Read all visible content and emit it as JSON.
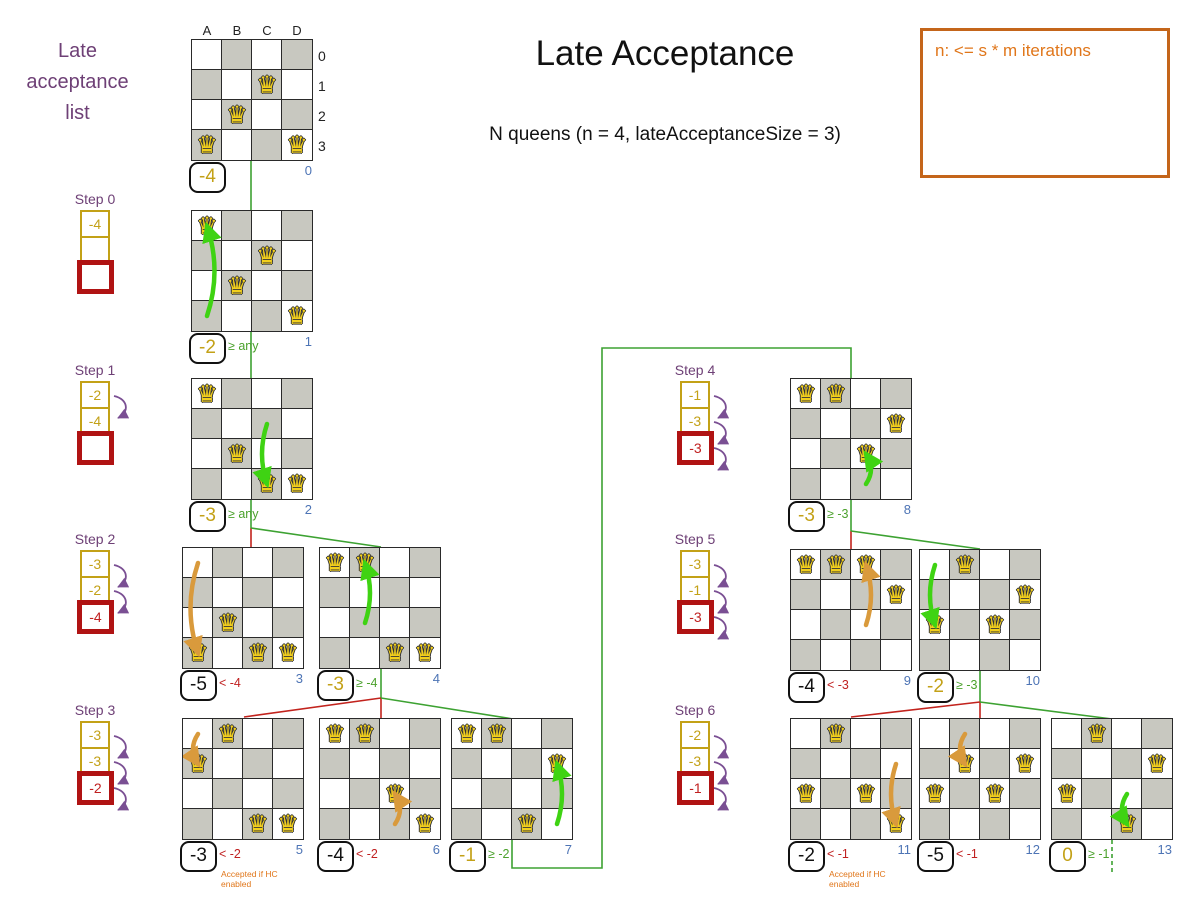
{
  "title": "Late Acceptance",
  "subtitle": "N queens (n = 4, lateAcceptanceSize = 3)",
  "info_box": {
    "text": "n: <= s * m iterations"
  },
  "left_label": {
    "text": "Late\nacceptance\nlist"
  },
  "icons": {
    "queen": "♛",
    "shift_arrow": "curved-purple-arrow"
  },
  "colors": {
    "gold": "#c3a117",
    "score_black": "#111111",
    "red_text": "#c02020",
    "red_line": "#c2231d",
    "red_cell_border": "#b01313",
    "green_text": "#4ba12c",
    "green_line": "#3da232",
    "green_arrow": "#3fd313",
    "orange_arrow": "#d99a3c",
    "orange_text": "#e0761a",
    "purple": "#6e4076",
    "purple_arrow": "#7a4f93",
    "blue_index": "#4d74b5",
    "cell_gray": "#c8c8c0",
    "cell_white": "#ffffff"
  },
  "board_labels": {
    "cols": [
      "A",
      "B",
      "C",
      "D"
    ],
    "rows": [
      "0",
      "1",
      "2",
      "3"
    ]
  },
  "steps": [
    {
      "label": "Step 0",
      "x": 80,
      "y": 191,
      "cells": [
        "-4",
        "",
        ""
      ],
      "arrows": 0
    },
    {
      "label": "Step 1",
      "x": 80,
      "y": 362,
      "cells": [
        "-2",
        "-4",
        ""
      ],
      "arrows": 1
    },
    {
      "label": "Step 2",
      "x": 80,
      "y": 531,
      "cells": [
        "-3",
        "-2",
        "-4"
      ],
      "arrows": 2
    },
    {
      "label": "Step 3",
      "x": 80,
      "y": 702,
      "cells": [
        "-3",
        "-3",
        "-2"
      ],
      "arrows": 3
    },
    {
      "label": "Step 4",
      "x": 680,
      "y": 362,
      "cells": [
        "-1",
        "-3",
        "-3"
      ],
      "arrows": 3
    },
    {
      "label": "Step 5",
      "x": 680,
      "y": 531,
      "cells": [
        "-3",
        "-1",
        "-3"
      ],
      "arrows": 3
    },
    {
      "label": "Step 6",
      "x": 680,
      "y": 702,
      "cells": [
        "-2",
        "-3",
        "-1"
      ],
      "arrows": 3
    }
  ],
  "boards": [
    {
      "id": 0,
      "x": 191,
      "y": 39,
      "queens": [
        "C1",
        "B2",
        "A3",
        "D3"
      ],
      "score": "-4",
      "score_color": "gold",
      "cond": "",
      "cond_color": "",
      "index": "0",
      "labels": true
    },
    {
      "id": 1,
      "x": 191,
      "y": 210,
      "queens": [
        "A0",
        "C1",
        "B2",
        "D3"
      ],
      "move": {
        "from": "A3",
        "to": "A0",
        "color": "green"
      },
      "score": "-2",
      "score_color": "gold",
      "cond": "≥ any",
      "cond_color": "green",
      "index": "1"
    },
    {
      "id": 2,
      "x": 191,
      "y": 378,
      "queens": [
        "A0",
        "B2",
        "C3",
        "D3"
      ],
      "move": {
        "from": "C1",
        "to": "C3",
        "color": "green"
      },
      "score": "-3",
      "score_color": "gold",
      "cond": "≥ any",
      "cond_color": "green",
      "index": "2"
    },
    {
      "id": 3,
      "x": 182,
      "y": 547,
      "queens": [
        "B2",
        "A3",
        "C3",
        "D3"
      ],
      "move": {
        "from": "A0",
        "to": "A3",
        "color": "orange"
      },
      "score": "-5",
      "score_color": "black",
      "cond": "< -4",
      "cond_color": "red",
      "index": "3"
    },
    {
      "id": 4,
      "x": 319,
      "y": 547,
      "queens": [
        "A0",
        "B0",
        "C3",
        "D3"
      ],
      "move": {
        "from": "B2",
        "to": "B0",
        "color": "green"
      },
      "score": "-3",
      "score_color": "gold",
      "cond": "≥ -4",
      "cond_color": "green",
      "index": "4"
    },
    {
      "id": 5,
      "x": 182,
      "y": 718,
      "queens": [
        "B0",
        "A1",
        "C3",
        "D3"
      ],
      "move": {
        "from": "A0",
        "to": "A1",
        "color": "orange"
      },
      "score": "-3",
      "score_color": "black",
      "cond": "< -2",
      "cond_color": "red",
      "index": "5",
      "note": "Accepted if HC enabled"
    },
    {
      "id": 6,
      "x": 319,
      "y": 718,
      "queens": [
        "A0",
        "B0",
        "C2",
        "D3"
      ],
      "move": {
        "from": "C3",
        "to": "C2",
        "color": "orange"
      },
      "score": "-4",
      "score_color": "black",
      "cond": "< -2",
      "cond_color": "red",
      "index": "6"
    },
    {
      "id": 7,
      "x": 451,
      "y": 718,
      "queens": [
        "A0",
        "B0",
        "D1",
        "C3"
      ],
      "move": {
        "from": "D3",
        "to": "D1",
        "color": "green"
      },
      "score": "-1",
      "score_color": "gold",
      "cond": "≥ -2",
      "cond_color": "green",
      "index": "7"
    },
    {
      "id": 8,
      "x": 790,
      "y": 378,
      "queens": [
        "A0",
        "B0",
        "D1",
        "C2"
      ],
      "move": {
        "from": "C3",
        "to": "C2",
        "color": "green"
      },
      "score": "-3",
      "score_color": "gold",
      "cond": "≥ -3",
      "cond_color": "green",
      "index": "8"
    },
    {
      "id": 9,
      "x": 790,
      "y": 549,
      "queens": [
        "A0",
        "B0",
        "C0",
        "D1"
      ],
      "move": {
        "from": "C2",
        "to": "C0",
        "color": "orange"
      },
      "score": "-4",
      "score_color": "black",
      "cond": "< -3",
      "cond_color": "red",
      "index": "9"
    },
    {
      "id": 10,
      "x": 919,
      "y": 549,
      "queens": [
        "B0",
        "D1",
        "A2",
        "C2"
      ],
      "move": {
        "from": "A0",
        "to": "A2",
        "color": "green"
      },
      "score": "-2",
      "score_color": "gold",
      "cond": "≥ -3",
      "cond_color": "green",
      "index": "10"
    },
    {
      "id": 11,
      "x": 790,
      "y": 718,
      "queens": [
        "B0",
        "A2",
        "C2",
        "D3"
      ],
      "move": {
        "from": "D1",
        "to": "D3",
        "color": "orange"
      },
      "score": "-2",
      "score_color": "black",
      "cond": "< -1",
      "cond_color": "red",
      "index": "11",
      "note": "Accepted if HC enabled"
    },
    {
      "id": 12,
      "x": 919,
      "y": 718,
      "queens": [
        "B1",
        "D1",
        "A2",
        "C2"
      ],
      "move": {
        "from": "B0",
        "to": "B1",
        "color": "orange"
      },
      "score": "-5",
      "score_color": "black",
      "cond": "< -1",
      "cond_color": "red",
      "index": "12"
    },
    {
      "id": 13,
      "x": 1051,
      "y": 718,
      "queens": [
        "B0",
        "D1",
        "A2",
        "C3"
      ],
      "move": {
        "from": "C2",
        "to": "C3",
        "color": "green"
      },
      "score": "0",
      "score_color": "gold",
      "cond": "≥ -1",
      "cond_color": "green",
      "index": "13"
    }
  ],
  "connectors": [
    {
      "color": "green",
      "points": [
        [
          251,
          161
        ],
        [
          251,
          528
        ]
      ]
    },
    {
      "color": "red",
      "points": [
        [
          251,
          528
        ],
        [
          251,
          548
        ]
      ]
    },
    {
      "color": "green",
      "points": [
        [
          251,
          528
        ],
        [
          381,
          547
        ]
      ]
    },
    {
      "color": "green",
      "points": [
        [
          381,
          669
        ],
        [
          381,
          698
        ]
      ]
    },
    {
      "color": "red",
      "points": [
        [
          381,
          698
        ],
        [
          381,
          719
        ]
      ]
    },
    {
      "color": "red",
      "points": [
        [
          381,
          698
        ],
        [
          244,
          717
        ]
      ]
    },
    {
      "color": "green",
      "points": [
        [
          381,
          698
        ],
        [
          513,
          719
        ]
      ]
    },
    {
      "color": "green",
      "points": [
        [
          512,
          840
        ],
        [
          512,
          868
        ],
        [
          602,
          868
        ],
        [
          602,
          348
        ],
        [
          851,
          348
        ],
        [
          851,
          379
        ]
      ]
    },
    {
      "color": "green",
      "points": [
        [
          851,
          500
        ],
        [
          851,
          531
        ]
      ]
    },
    {
      "color": "red",
      "points": [
        [
          851,
          531
        ],
        [
          851,
          550
        ]
      ]
    },
    {
      "color": "green",
      "points": [
        [
          851,
          531
        ],
        [
          980,
          549
        ]
      ]
    },
    {
      "color": "green",
      "points": [
        [
          980,
          671
        ],
        [
          980,
          702
        ]
      ]
    },
    {
      "color": "red",
      "points": [
        [
          980,
          702
        ],
        [
          980,
          719
        ]
      ]
    },
    {
      "color": "red",
      "points": [
        [
          980,
          702
        ],
        [
          851,
          717
        ]
      ]
    },
    {
      "color": "green",
      "points": [
        [
          980,
          702
        ],
        [
          1112,
          719
        ]
      ]
    },
    {
      "color": "green",
      "dash": true,
      "points": [
        [
          1112,
          840
        ],
        [
          1112,
          872
        ]
      ]
    }
  ]
}
